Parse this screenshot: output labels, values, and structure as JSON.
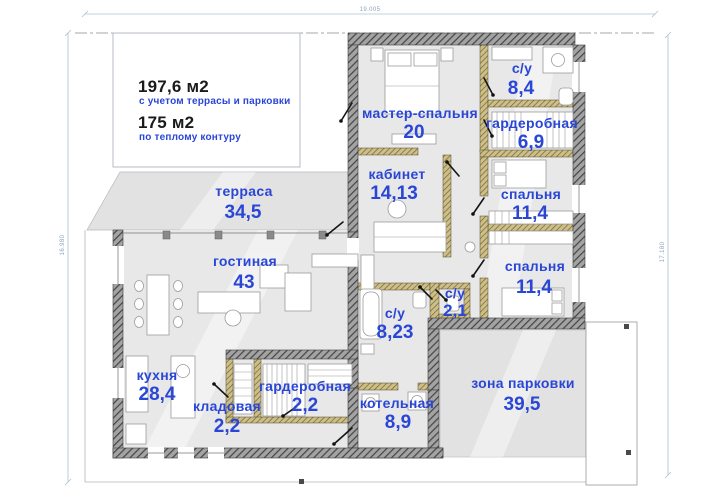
{
  "summary": {
    "total_area": "197,6 м2",
    "total_area_note": "с учетом террасы и парковки",
    "heated_area": "175 м2",
    "heated_area_note": "по теплому контуру"
  },
  "dimensions": {
    "top": "19.005",
    "left": "16.980",
    "right": "17.180"
  },
  "rooms": [
    {
      "id": "terrace",
      "name": "терраса",
      "area": "34,5"
    },
    {
      "id": "living-room",
      "name": "гостиная",
      "area": "43"
    },
    {
      "id": "master-bedroom",
      "name": "мастер-спальня",
      "area": "20"
    },
    {
      "id": "bathroom-master",
      "name": "с/у",
      "area": "8,4"
    },
    {
      "id": "wardrobe-master",
      "name": "гардеробная",
      "area": "6,9"
    },
    {
      "id": "office",
      "name": "кабинет",
      "area": "14,13"
    },
    {
      "id": "bedroom-1",
      "name": "спальня",
      "area": "11,4"
    },
    {
      "id": "bedroom-2",
      "name": "спальня",
      "area": "11,4"
    },
    {
      "id": "bathroom-main",
      "name": "с/у",
      "area": "8,23"
    },
    {
      "id": "bathroom-guest",
      "name": "с/у",
      "area": "2,1"
    },
    {
      "id": "kitchen",
      "name": "кухня",
      "area": "28,4"
    },
    {
      "id": "pantry",
      "name": "кладовая",
      "area": "2,2"
    },
    {
      "id": "wardrobe-hall",
      "name": "гардеробная",
      "area": "2,2"
    },
    {
      "id": "boiler-room",
      "name": "котельная",
      "area": "8,9"
    },
    {
      "id": "parking",
      "name": "зона парковки",
      "area": "39,5"
    }
  ],
  "colors": {
    "label_blue": "#2946d6",
    "floor_gray": "#e8e8e8",
    "outdoor_gray": "#e2e2e2",
    "wall_dark": "#8f8f8f",
    "wall_khaki": "#cdbf85",
    "dimension_gray_blue": "#8ba2b8"
  }
}
